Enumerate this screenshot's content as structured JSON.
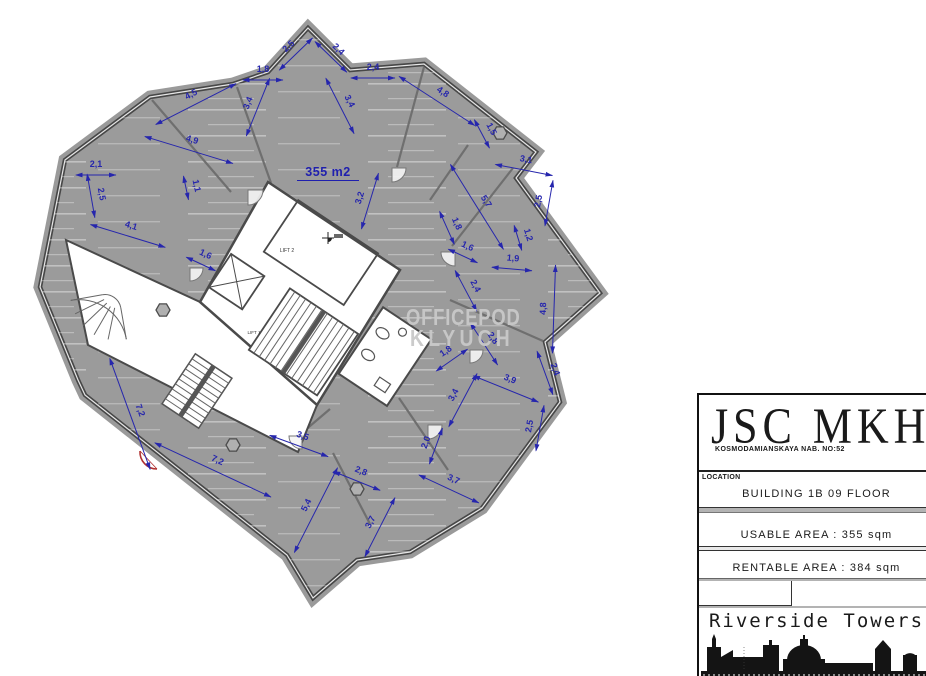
{
  "plan": {
    "area_label": "355 m2",
    "core_labels": {
      "lift2": "LIFT 2",
      "lift1": "LIFT 1"
    },
    "dimensions": [
      {
        "label": "2,5",
        "x": 296,
        "y": 54,
        "r": -44,
        "l": 46
      },
      {
        "label": "2,4",
        "x": 331,
        "y": 57,
        "r": 44,
        "l": 44
      },
      {
        "label": "1,8",
        "x": 263,
        "y": 80,
        "r": 0,
        "l": 40
      },
      {
        "label": "4,5",
        "x": 196,
        "y": 104,
        "r": -27,
        "l": 90
      },
      {
        "label": "3,4",
        "x": 258,
        "y": 107,
        "r": -68,
        "l": 62
      },
      {
        "label": "3,4",
        "x": 340,
        "y": 106,
        "r": 63,
        "l": 62
      },
      {
        "label": "2,4",
        "x": 373,
        "y": 78,
        "r": 0,
        "l": 44
      },
      {
        "label": "4,8",
        "x": 437,
        "y": 101,
        "r": 33,
        "l": 90
      },
      {
        "label": "1,5",
        "x": 482,
        "y": 134,
        "r": 62,
        "l": 32
      },
      {
        "label": "3,1",
        "x": 524,
        "y": 170,
        "r": 11,
        "l": 58
      },
      {
        "label": "2,5",
        "x": 549,
        "y": 203,
        "r": -80,
        "l": 46
      },
      {
        "label": "5,7",
        "x": 477,
        "y": 207,
        "r": 58,
        "l": 100
      },
      {
        "label": "1,8",
        "x": 447,
        "y": 228,
        "r": 66,
        "l": 36
      },
      {
        "label": "1,6",
        "x": 463,
        "y": 256,
        "r": 25,
        "l": 32
      },
      {
        "label": "1,2",
        "x": 518,
        "y": 238,
        "r": 73,
        "l": 26
      },
      {
        "label": "1,9",
        "x": 512,
        "y": 269,
        "r": 5,
        "l": 40
      },
      {
        "label": "2,4",
        "x": 466,
        "y": 291,
        "r": 62,
        "l": 46
      },
      {
        "label": "4,8",
        "x": 554,
        "y": 309,
        "r": -88,
        "l": 88
      },
      {
        "label": "3,2",
        "x": 370,
        "y": 201,
        "r": -73,
        "l": 58
      },
      {
        "label": "1,8",
        "x": 452,
        "y": 360,
        "r": -35,
        "l": 38
      },
      {
        "label": "2,8",
        "x": 484,
        "y": 344,
        "r": 57,
        "l": 50
      },
      {
        "label": "3,9",
        "x": 506,
        "y": 389,
        "r": 22,
        "l": 70
      },
      {
        "label": "2,4",
        "x": 545,
        "y": 373,
        "r": 70,
        "l": 46
      },
      {
        "label": "3,4",
        "x": 463,
        "y": 400,
        "r": -62,
        "l": 60
      },
      {
        "label": "2,5",
        "x": 540,
        "y": 428,
        "r": -80,
        "l": 46
      },
      {
        "label": "2,0",
        "x": 436,
        "y": 446,
        "r": -70,
        "l": 38
      },
      {
        "label": "3,7",
        "x": 449,
        "y": 489,
        "r": 25,
        "l": 66
      },
      {
        "label": "3,5",
        "x": 299,
        "y": 446,
        "r": 20,
        "l": 62
      },
      {
        "label": "2,8",
        "x": 357,
        "y": 481,
        "r": 22,
        "l": 50
      },
      {
        "label": "5,4",
        "x": 316,
        "y": 510,
        "r": -63,
        "l": 95
      },
      {
        "label": "3,7",
        "x": 380,
        "y": 527,
        "r": -63,
        "l": 66
      },
      {
        "label": "7,2",
        "x": 130,
        "y": 414,
        "r": 70,
        "l": 118
      },
      {
        "label": "7,2",
        "x": 213,
        "y": 470,
        "r": 25,
        "l": 128
      },
      {
        "label": "4,9",
        "x": 189,
        "y": 150,
        "r": 17,
        "l": 92
      },
      {
        "label": "2,1",
        "x": 96,
        "y": 175,
        "r": 0,
        "l": 40
      },
      {
        "label": "2,5",
        "x": 91,
        "y": 196,
        "r": 80,
        "l": 44
      },
      {
        "label": "1,1",
        "x": 186,
        "y": 188,
        "r": 78,
        "l": 24
      },
      {
        "label": "4,1",
        "x": 128,
        "y": 236,
        "r": 17,
        "l": 78
      },
      {
        "label": "1,6",
        "x": 201,
        "y": 264,
        "r": 25,
        "l": 32
      }
    ]
  },
  "watermark": {
    "line1": "OFFICEPOD",
    "line2": "KLYUCH"
  },
  "title_block": {
    "company": "JSC MKH",
    "address": "KOSMODAMIANSKAYA NAB. NO:52",
    "location_label": "LOCATION",
    "location_value": "BUILDING 1B 09 FLOOR",
    "usable_area": "USABLE AREA : 355 sqm",
    "rentable_area": "RENTABLE AREA : 384 sqm",
    "project": "Riverside Towers"
  },
  "colors": {
    "dimension": "#2626ad",
    "floor": "#9b9b9b",
    "wall": "#474747",
    "watermark": "#c9c9c9",
    "red_accent": "#b03030"
  }
}
